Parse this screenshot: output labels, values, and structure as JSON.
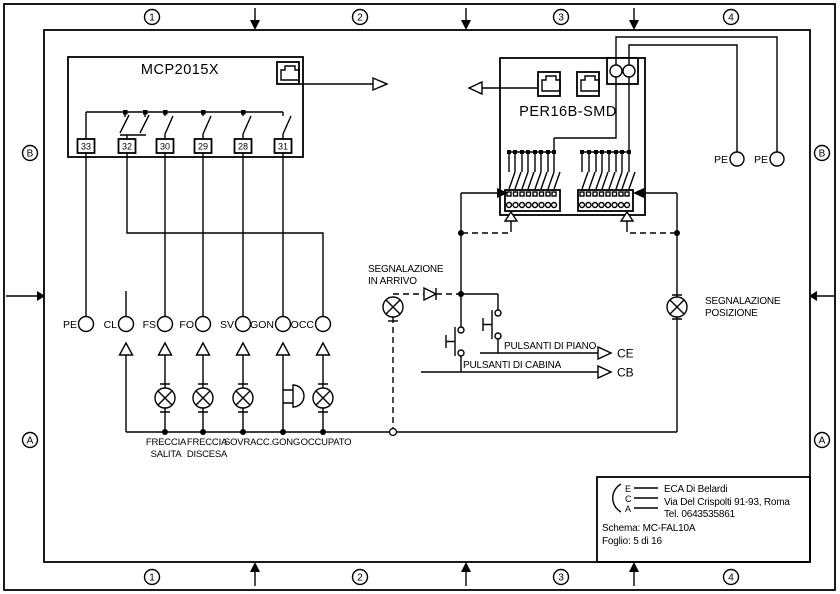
{
  "frame": {
    "columns": [
      "1",
      "2",
      "3",
      "4"
    ],
    "rows": [
      "B",
      "A"
    ]
  },
  "mcp": {
    "title": "MCP2015X",
    "terminals": [
      "33",
      "32",
      "30",
      "29",
      "28",
      "31"
    ]
  },
  "per": {
    "title": "PER16B-SMD"
  },
  "signals": {
    "labels": [
      "PE",
      "CL",
      "FS",
      "FO",
      "SV",
      "GON",
      "OCC"
    ]
  },
  "lamps": {
    "labels": [
      [
        "FRECCIA",
        "SALITA"
      ],
      [
        "FRECCIA",
        "DISCESA"
      ],
      [
        "SOVRACC."
      ],
      [
        "GONG"
      ],
      [
        "OCCUPATO"
      ]
    ]
  },
  "annotations": {
    "in_arrivo": [
      "SEGNALAZIONE",
      "IN ARRIVO"
    ],
    "posizione": [
      "SEGNALAZIONE",
      "POSIZIONE"
    ],
    "pulsanti_piano": "PULSANTI DI PIANO",
    "pulsanti_cabina": "PULSANTI DI CABINA",
    "ce": "CE",
    "cb": "CB",
    "pe": "PE"
  },
  "title_block": {
    "logo": [
      "E",
      "C",
      "A"
    ],
    "company": "ECA Di Belardi",
    "address": "Via Del Crispolti 91-93, Roma",
    "phone": "Tel. 0643535861",
    "schema": "Schema: MC-FAL10A",
    "sheet": "Foglio: 5 di 16"
  },
  "colors": {
    "ink": "#000000",
    "paper": "#ffffff"
  }
}
